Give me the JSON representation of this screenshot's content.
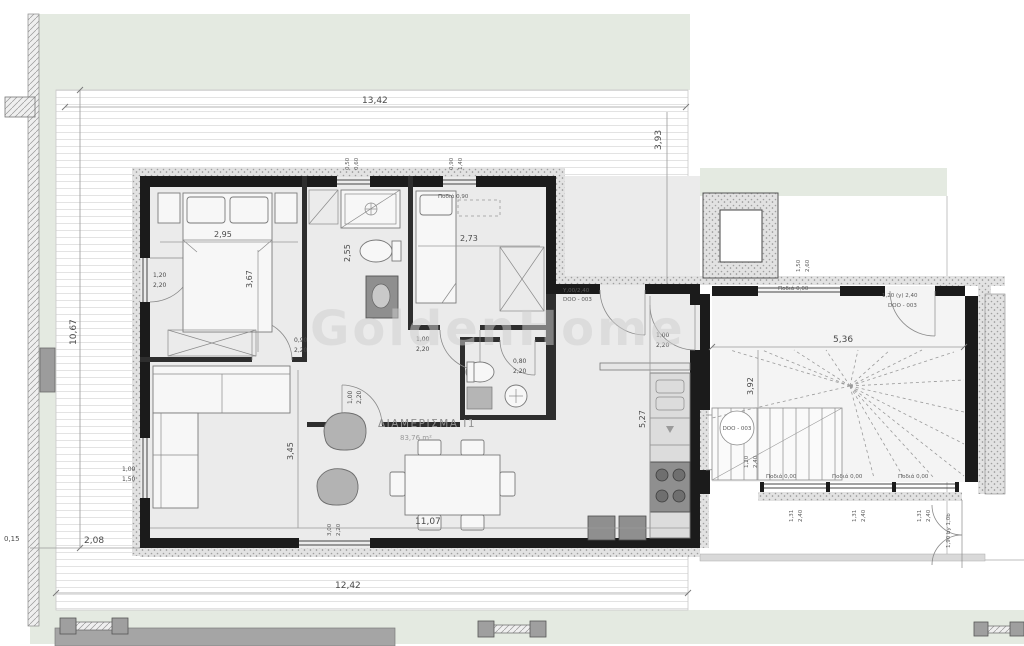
{
  "plan": {
    "title": "ΔΙΑΜΕΡΙΣΜΑ Ι1",
    "area": "83,76 m²",
    "watermark": "GoldenHome"
  },
  "colors": {
    "lawn": "#e4eae1",
    "paper": "#ffffff",
    "wall": "#1b1b1b",
    "room_floor": "#ebebeb",
    "walkway": "#a5a5a5"
  },
  "dims": {
    "top_width": "13,42",
    "top_terrace_depth": "3,93",
    "left_height": "10,67",
    "left_setback": "2,08",
    "left_offset": "0,15",
    "bottom_width": "12,42",
    "interior_width": "11,07",
    "living_height": "3,45",
    "kitchen_height": "5,27",
    "stair_width": "5,36",
    "stair_height": "3,92",
    "bed1_width": "2,95",
    "bed1_height": "3,67",
    "bath_height": "2,55",
    "bed2_width": "2,73"
  },
  "openings": {
    "bed1_window": {
      "w": "1,20",
      "h": "2,20"
    },
    "living_window": {
      "w": "1,00",
      "h": "1,50"
    },
    "bed1_door": {
      "w": "0,90",
      "h": "2,20"
    },
    "bath_door": {
      "w": "1,00",
      "h": "2,20"
    },
    "bed2_door": {
      "w": "1,00",
      "h": "2,20"
    },
    "wc_door": {
      "w": "0,80",
      "h": "2,20"
    },
    "kitchen_door": {
      "w": "1,00",
      "h": "2,20"
    },
    "bath_window": {
      "w": "0,50",
      "h": "0,60"
    },
    "bed2_window": {
      "w": "0,90",
      "h": "1,40"
    },
    "upper_window": {
      "w": "1,50",
      "h": "2,60"
    },
    "living_slider": {
      "w": "3,00",
      "h": "2,20"
    },
    "stair_window": {
      "w": "1,31",
      "h": "2,40"
    },
    "entry_door": {
      "w": "1,20",
      "h": "2,40"
    }
  },
  "notes": {
    "sill_zero": "Ποδιά 0,00",
    "sill_high": "Ποδιά 0,90",
    "door_code": "DOO - 003",
    "hall_door_tag": "Υ,00/2,40",
    "stair_door_tag": "1,20 (y) 2,40",
    "gate_note": "1,90 by 1,0b"
  }
}
